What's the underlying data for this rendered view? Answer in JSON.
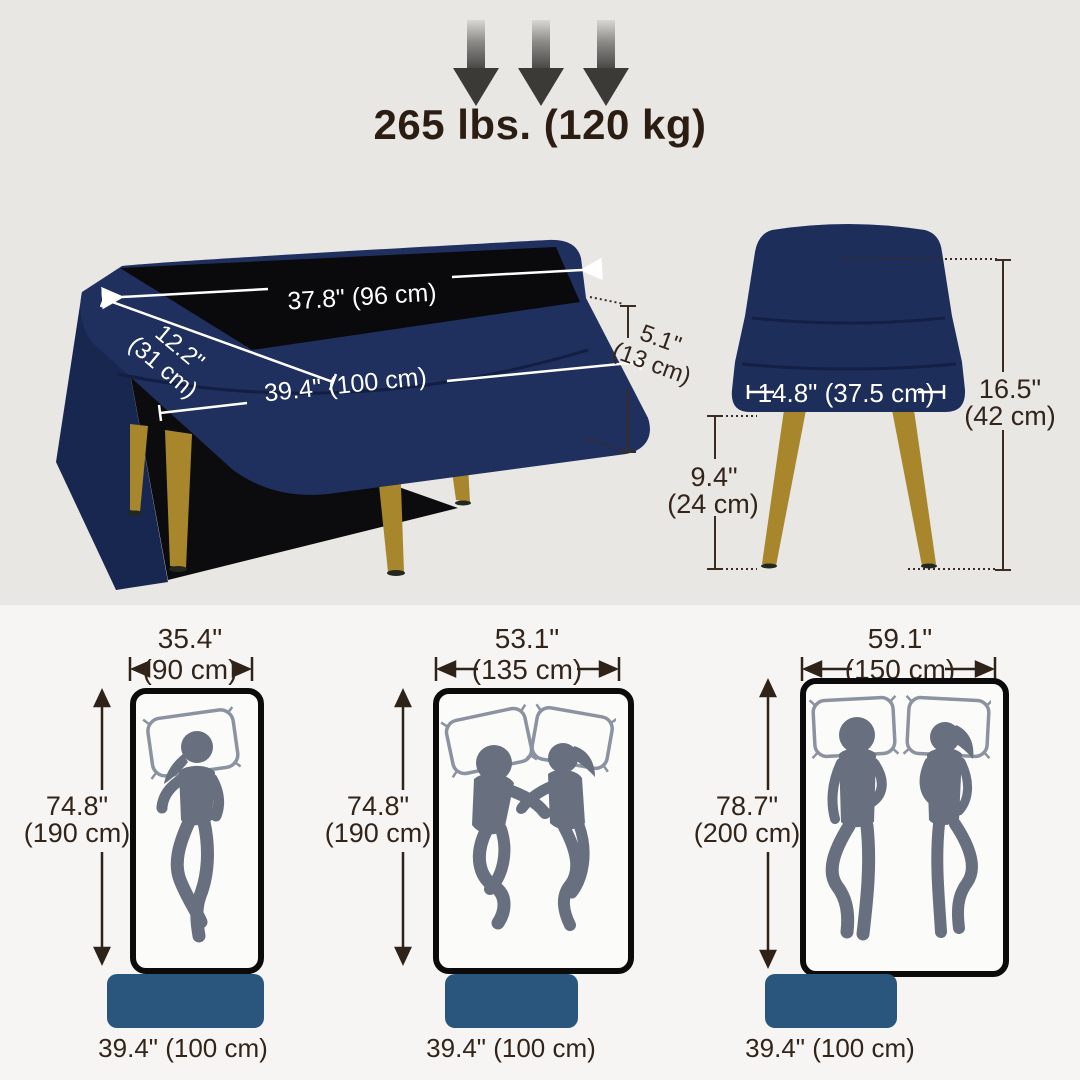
{
  "weight": {
    "label": "265 lbs. (120 kg)"
  },
  "open_view": {
    "top_length": "37.8\" (96 cm)",
    "depth_in": "12.2\"",
    "depth_cm": "(31 cm)",
    "overall_length": "39.4\" (100 cm)",
    "lid_height_in": "5.1\"",
    "lid_height_cm": "(13 cm)"
  },
  "side_view": {
    "seat_width": "14.8\" (37.5 cm)",
    "overall_height_in": "16.5\"",
    "overall_height_cm": "(42 cm)",
    "leg_height_in": "9.4\"",
    "leg_height_cm": "(24 cm)"
  },
  "mattresses": [
    {
      "width_in": "35.4\"",
      "width_cm": "(90 cm)",
      "length_in": "74.8\"",
      "length_cm": "(190 cm)",
      "bench_length": "39.4\" (100 cm)",
      "sleepers": "1"
    },
    {
      "width_in": "53.1\"",
      "width_cm": "(135 cm)",
      "length_in": "74.8\"",
      "length_cm": "(190 cm)",
      "bench_length": "39.4\" (100 cm)",
      "sleepers": "2"
    },
    {
      "width_in": "59.1\"",
      "width_cm": "(150 cm)",
      "length_in": "78.7\"",
      "length_cm": "(200 cm)",
      "bench_length": "39.4\" (100 cm)",
      "sleepers": "2"
    }
  ],
  "colors": {
    "bench_navy": "#1e2e5b",
    "leg_gold": "#a8872c",
    "bench_blue": "#2a567e",
    "figure_gray": "#68707f",
    "annotation_dark": "#33241a",
    "annotation_white": "#ffffff",
    "bg_top": "#e8e7e4",
    "bg_bottom": "#f6f5f3"
  }
}
